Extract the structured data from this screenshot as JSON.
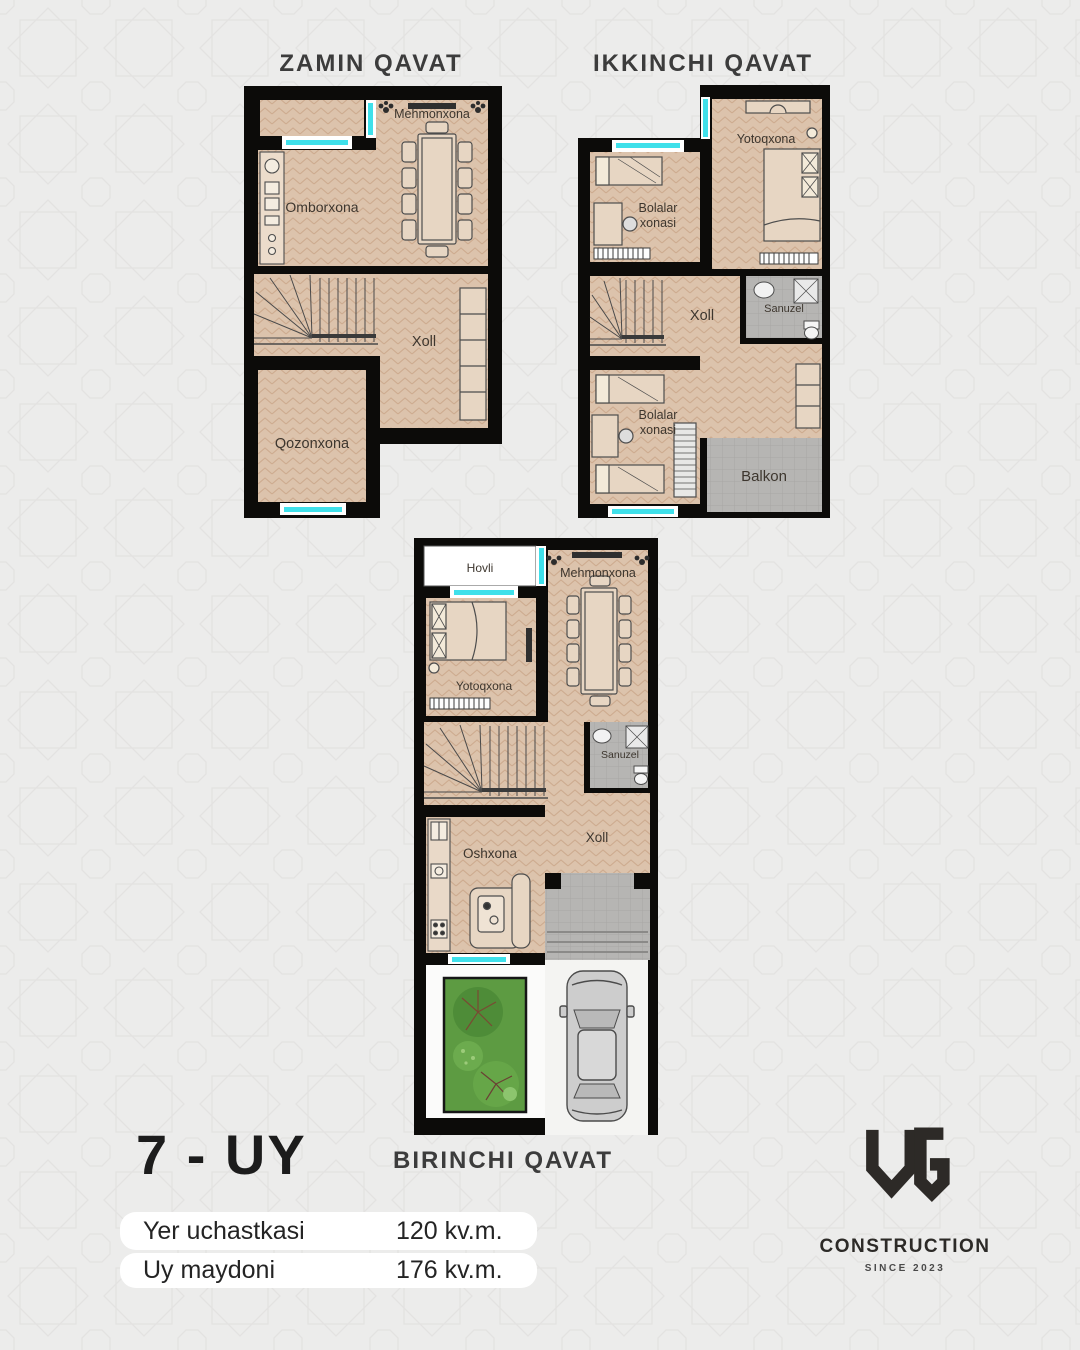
{
  "poster": {
    "house_no": "7 - UY",
    "stats": [
      {
        "label": "Yer uchastkasi",
        "value": "120 kv.m."
      },
      {
        "label": "Uy maydoni",
        "value": "176 kv.m."
      }
    ],
    "logo": {
      "monogram": "UG",
      "name": "CONSTRUCTION",
      "since": "SINCE 2023"
    }
  },
  "plans": [
    {
      "title": "ZAMIN QAVAT",
      "rooms": [
        {
          "label": "Mehmonxona"
        },
        {
          "label": "Omborxona"
        },
        {
          "label": "Xoll"
        },
        {
          "label": "Qozonxona"
        }
      ]
    },
    {
      "title": "IKKINCHI QAVAT",
      "rooms": [
        {
          "label": "Yotoqxona"
        },
        {
          "label": "Bolalar xonasi",
          "line1": "Bolalar",
          "line2": "xonasi"
        },
        {
          "label": "Sanuzel"
        },
        {
          "label": "Xoll"
        },
        {
          "label": "Bolalar xonasi",
          "line1": "Bolalar",
          "line2": "xonasi"
        },
        {
          "label": "Balkon"
        }
      ]
    },
    {
      "title": "BIRINCHI QAVAT",
      "rooms": [
        {
          "label": "Hovli"
        },
        {
          "label": "Mehmonxona"
        },
        {
          "label": "Yotoqxona"
        },
        {
          "label": "Sanuzel"
        },
        {
          "label": "Xoll"
        },
        {
          "label": "Oshxona"
        }
      ]
    }
  ],
  "colors": {
    "background": "#ececeb",
    "wall_black": "#0c0b09",
    "floor_wood": "#dcc3ac",
    "tile_gray": "#b6b5b3",
    "window_cyan": "#3fe0ea",
    "garden_green": "#5d9b42",
    "pill_white": "#ffffff"
  }
}
